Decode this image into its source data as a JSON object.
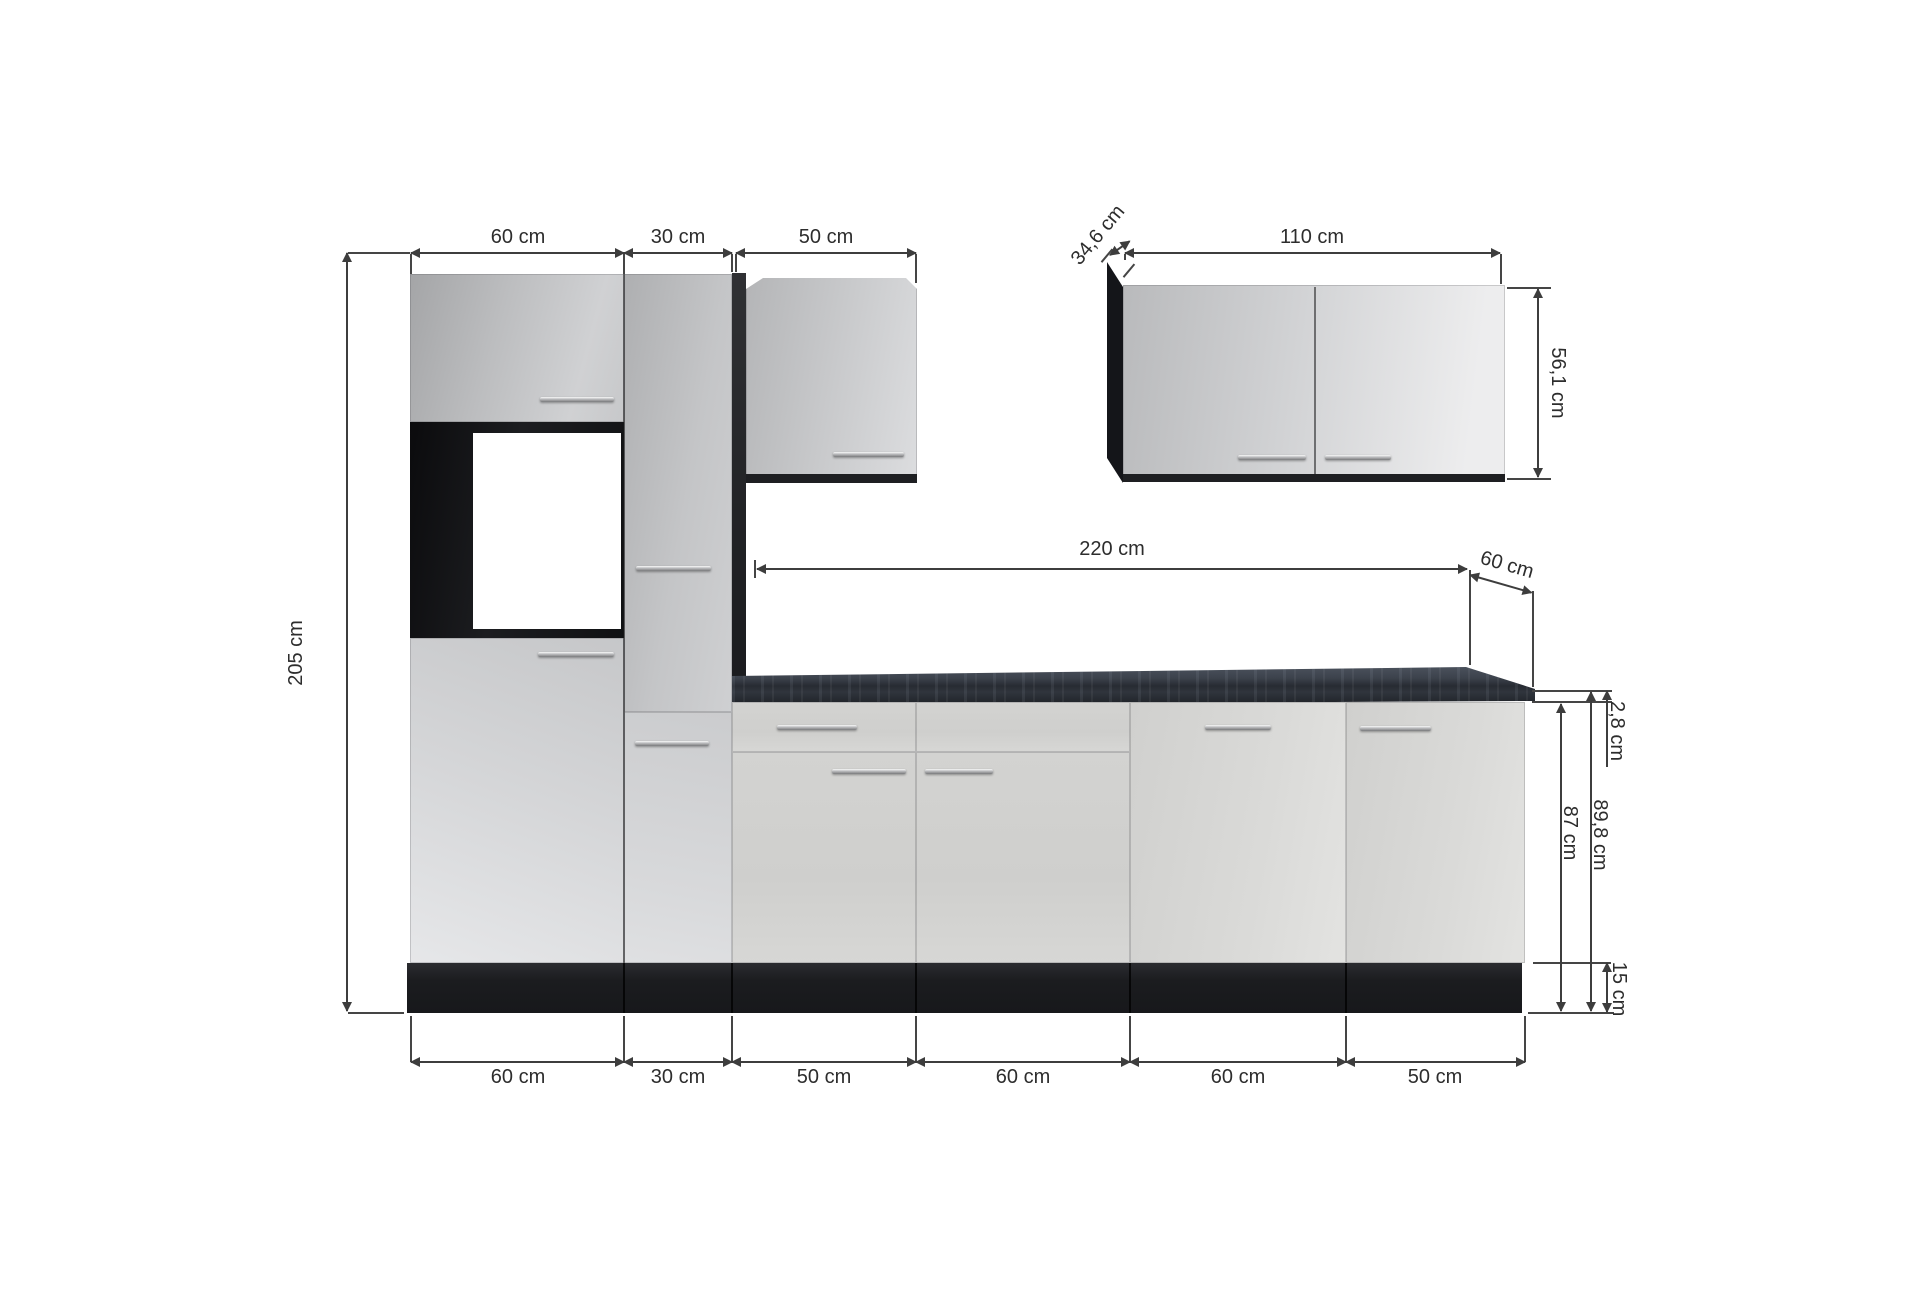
{
  "diagram": {
    "subject": "kitchen-unit-dimension-drawing",
    "dims": {
      "left_height": "205 cm",
      "top_60": "60 cm",
      "top_30": "30 cm",
      "top_50": "50 cm",
      "wall_depth": "34,6 cm",
      "wall_width": "110 cm",
      "wall_height": "56,1 cm",
      "counter_length": "220 cm",
      "counter_depth": "60 cm",
      "counter_thickness": "2,8 cm",
      "height_incl_worktop": "89,8 cm",
      "height_base": "87 cm",
      "plinth_height": "15 cm",
      "bottom_1": "60 cm",
      "bottom_2": "30 cm",
      "bottom_3": "50 cm",
      "bottom_4": "60 cm",
      "bottom_5": "60 cm",
      "bottom_6": "50 cm"
    },
    "colors": {
      "background": "#ffffff",
      "cabinet_front_light": "#cfd0d2",
      "carcass_dark": "#1d1e21",
      "countertop_dark": "#2b3038",
      "dimension_line": "#3d3d3d"
    }
  }
}
